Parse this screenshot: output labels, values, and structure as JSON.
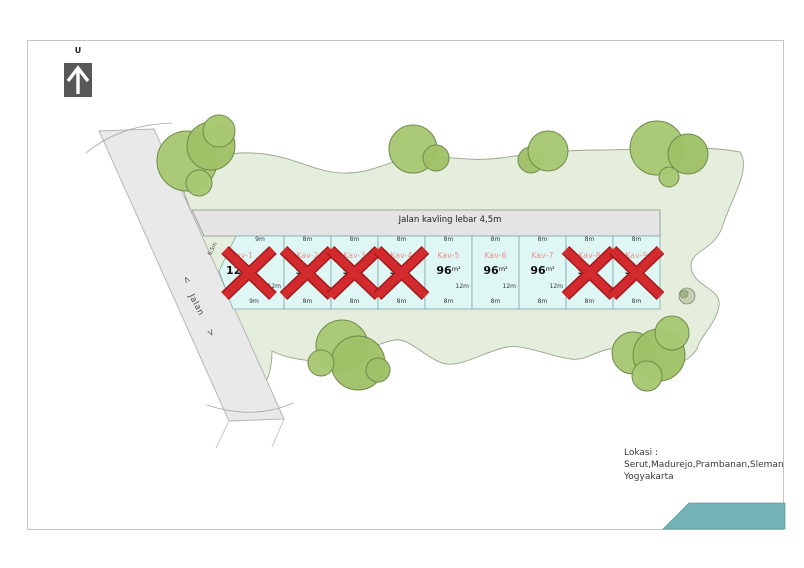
{
  "compass": {
    "label": "U"
  },
  "roads": {
    "main_label": "Jalan",
    "arrow_up": "<",
    "arrow_down": ">",
    "kavling_label": "Jalan kavling lebar 4,5m",
    "edge_dimension": "6,5m"
  },
  "plots": [
    {
      "name": "Kav-1",
      "area": "120",
      "unit": "m²",
      "top_dim": "9m",
      "bottom_dim": "9m",
      "side_dim": "12m",
      "sold": true
    },
    {
      "name": "Kav-2",
      "area": "96",
      "unit": "m²",
      "top_dim": "8m",
      "bottom_dim": "8m",
      "side_dim": "12m",
      "sold": true
    },
    {
      "name": "Kav-3",
      "area": "96",
      "unit": "m²",
      "top_dim": "8m",
      "bottom_dim": "8m",
      "side_dim": "12m",
      "sold": true
    },
    {
      "name": "Kav-4",
      "area": "96",
      "unit": "m²",
      "top_dim": "8m",
      "bottom_dim": "8m",
      "side_dim": "12m",
      "sold": true
    },
    {
      "name": "Kav-5",
      "area": "96",
      "unit": "m²",
      "top_dim": "8m",
      "bottom_dim": "8m",
      "side_dim": "12m",
      "sold": false
    },
    {
      "name": "Kav-6",
      "area": "96",
      "unit": "m²",
      "top_dim": "8m",
      "bottom_dim": "8m",
      "side_dim": "12m",
      "sold": false
    },
    {
      "name": "Kav-7",
      "area": "96",
      "unit": "m²",
      "top_dim": "8m",
      "bottom_dim": "8m",
      "side_dim": "12m",
      "sold": false
    },
    {
      "name": "Kav-8",
      "area": "96",
      "unit": "m²",
      "top_dim": "8m",
      "bottom_dim": "8m",
      "side_dim": "12m",
      "sold": true
    },
    {
      "name": "Kav-9",
      "area": "96",
      "unit": "m²",
      "top_dim": "8m",
      "bottom_dim": "8m",
      "side_dim": "12m",
      "sold": true
    }
  ],
  "location": {
    "label": "Lokasi :",
    "line1": "Serut,Madurejo,Prambanan,Sleman",
    "line2": "Yogyakarta"
  },
  "colors": {
    "accent_teal": "#73b2b7",
    "sold_x": "#d22a2d",
    "plot_fill": "#def6f4",
    "land_green": "#e5eedd",
    "tree_green": "#a8c873",
    "kav_name": "#ec8f8a"
  }
}
